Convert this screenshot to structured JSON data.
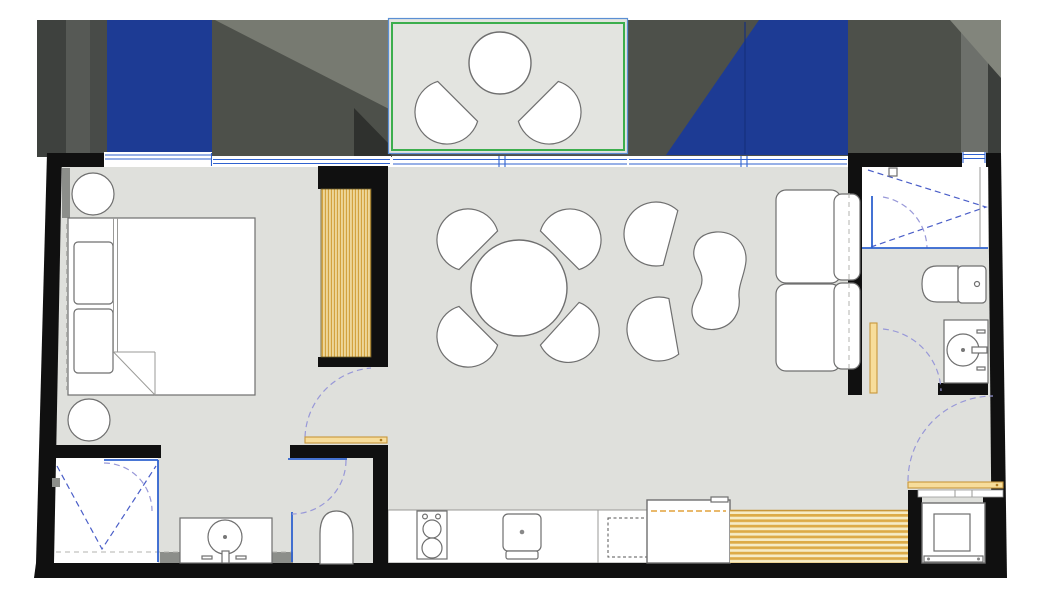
{
  "app": {
    "type": "apartment-floor-plan",
    "visible_text": [],
    "canvas": {
      "width": 1044,
      "height": 601
    }
  },
  "palette": {
    "wall": "#101010",
    "floor": "#dfe0dc",
    "terraceFloor": "#e3e4e0",
    "exterior": "#4d504a",
    "exteriorDark": "#3a3d39",
    "exteriorBand1": "#3e413e",
    "exteriorBand2": "#565955",
    "exteriorBand3": "#484b48",
    "exteriorLight": "#777a71",
    "exteriorLighter": "#82857c",
    "exteriorShadow": "#2f312e",
    "awningBlue": "#1d3b94",
    "awningSeam": "#16307c",
    "glassBlue": "#2f62cf",
    "glassLight": "#5b8fd4",
    "terraceGreen": "#3cae4d",
    "doorArc": "#9898d8",
    "showerDash": "#4a5ec8",
    "woodDark": "#c8973b",
    "woodLight": "#f4e4b0",
    "doorLeaf": "#f7dd9b",
    "applianceDash": "#e2a23c",
    "furnitureStroke": "#6f6f6f",
    "grayStub": "#8c8e8a",
    "white": "#ffffff"
  },
  "rooms": [
    {
      "name": "bedroom"
    },
    {
      "name": "ensuite-bathroom"
    },
    {
      "name": "living-dining"
    },
    {
      "name": "kitchen"
    },
    {
      "name": "second-bathroom"
    },
    {
      "name": "terrace"
    },
    {
      "name": "laundry-niche"
    }
  ],
  "furniture": [
    {
      "name": "double-bed",
      "room": "bedroom"
    },
    {
      "name": "nightstand",
      "room": "bedroom",
      "count": 2
    },
    {
      "name": "louvered-wardrobe",
      "room": "bedroom"
    },
    {
      "name": "round-dining-table",
      "room": "living-dining"
    },
    {
      "name": "dining-chair",
      "room": "living-dining",
      "count": 4
    },
    {
      "name": "lounge-chair",
      "room": "living-dining",
      "count": 2
    },
    {
      "name": "kidney-coffee-table",
      "room": "living-dining"
    },
    {
      "name": "two-seat-sofa",
      "room": "living-dining"
    },
    {
      "name": "round-terrace-table",
      "room": "terrace"
    },
    {
      "name": "terrace-chair",
      "room": "terrace",
      "count": 2
    },
    {
      "name": "slatted-bench",
      "room": "kitchen"
    }
  ],
  "fixtures": [
    {
      "name": "shower",
      "room": "ensuite-bathroom"
    },
    {
      "name": "vanity-sink",
      "room": "ensuite-bathroom"
    },
    {
      "name": "toilet",
      "room": "ensuite-bathroom"
    },
    {
      "name": "shower",
      "room": "second-bathroom"
    },
    {
      "name": "toilet",
      "room": "second-bathroom"
    },
    {
      "name": "vanity-sink",
      "room": "second-bathroom"
    },
    {
      "name": "cooktop-two-burner",
      "room": "kitchen"
    },
    {
      "name": "kitchen-sink",
      "room": "kitchen"
    },
    {
      "name": "dishwasher-hidden",
      "room": "kitchen"
    },
    {
      "name": "refrigerator",
      "room": "kitchen"
    },
    {
      "name": "washing-machine",
      "room": "laundry-niche"
    }
  ],
  "doors": [
    {
      "name": "bedroom-door",
      "type": "swing"
    },
    {
      "name": "wc-door",
      "type": "swing"
    },
    {
      "name": "second-bathroom-door",
      "type": "swing"
    },
    {
      "name": "laundry-entry-door",
      "type": "swing"
    }
  ],
  "windows": [
    {
      "name": "bedroom-window-left"
    },
    {
      "name": "bedroom-window-right"
    },
    {
      "name": "terrace-glass-door"
    },
    {
      "name": "living-window"
    },
    {
      "name": "bathroom-window"
    }
  ],
  "outdoor": {
    "awnings": 2,
    "terrace_border": "green-outline"
  }
}
